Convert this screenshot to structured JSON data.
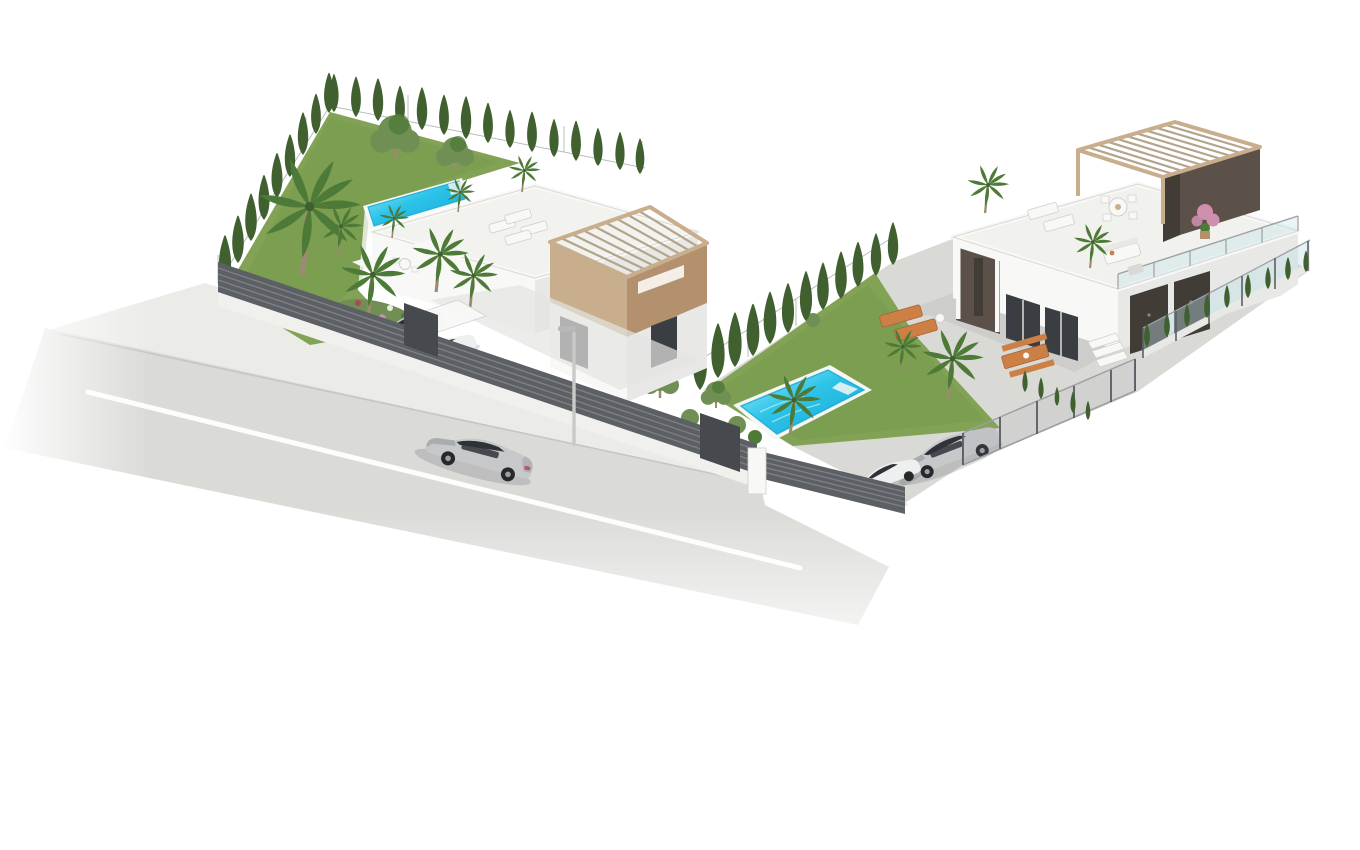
{
  "meta": {
    "type": "architectural-3d-render",
    "description": "Isometric 3D architectural rendering of two modern white villas on an L-shaped plot with gardens, swimming pools, cypress hedges, palm trees, parked cars, dark slatted street fences and a grey asphalt road with a silver sedan, on a plain white background"
  },
  "colors": {
    "bg": "#ffffff",
    "road": "#dadad7",
    "roadEdge": "#c6c6c3",
    "lane": "#fdfdfc",
    "sidewalk": "#ebebe8",
    "grass": "#82a355",
    "grassShade": "#6a8f46",
    "cypress": "#41602f",
    "olive": "#6f8f55",
    "palm": "#4e7a38",
    "trunk": "#9b8b70",
    "water": "#2ec4e9",
    "waterDeep": "#12a7d4",
    "waterLight": "#9ff0fb",
    "coping": "#f6f6f4",
    "white1": "#f8f8f6",
    "white2": "#e8e9e6",
    "white3": "#d8d9d6",
    "edge": "#cfd0cd",
    "tan": "#c9ae8d",
    "tanShade": "#b3916e",
    "beam": "#b3a48c",
    "brown": "#5c5149",
    "brownDark": "#423c36",
    "window": "#3a3e42",
    "fence": "#5c5f63",
    "fenceLine": "#83868a",
    "fenceDark": "#46494d",
    "wallBase": "#f0f0ed",
    "concrete": "#d9d9d6",
    "concreteLight": "#e4e4e1",
    "silver": "#c6c8ca",
    "silverShade": "#93979a",
    "carWhite": "#eef0f0",
    "carGlass": "#2f3338",
    "orange": "#cd8045",
    "orangeDark": "#a9632f",
    "glass": "#bfdfe9",
    "wire": "#9aa0a3",
    "pink": "#cf8fae",
    "flowerRed": "#b3455a",
    "shadow": "rgba(60,65,70,0.18)"
  },
  "scene": {
    "background": "plain white, no horizon",
    "road": {
      "label": "asphalt road running diagonally lower-left, white edge line, fading to white at borders"
    },
    "street_lamp": {
      "label": "slim grey street lamp on sidewalk"
    },
    "vehicles": {
      "driving_car": "silver sedan driving on the road",
      "left_plot_cars": [
        "silver car parked behind street fence",
        "white car under white carport canopy"
      ],
      "right_plot_cars": [
        "silver coupe parked in driveway",
        "white car parked beside it"
      ]
    },
    "left_villa": {
      "label": "two-storey modern white villa",
      "features": [
        "white roof terrace with sun loungers and potted plants",
        "beige upper tower with slatted pergola roof and slot window",
        "dark glazed windows",
        "lap pool along terrace edge",
        "lawn with tall palm, olive trees and cypress hedges on two sides",
        "flower bed with pink and red blooms",
        "lower patio with white dining set",
        "dark horizontal-slat street fence with gates and white pillar"
      ]
    },
    "right_villa": {
      "label": "single-storey modern white villa with roof terrace",
      "features": [
        "roof terrace with wooden pergola and dark brown wall",
        "round dining table with chairs, two loungers, white sofa set, potted plants, pink shrub",
        "glass railing on terrace edge",
        "covered porch with columns",
        "dark sliding glass doors and garage panels",
        "entrance steps",
        "front patio with two orange loungers and orange picnic table",
        "palm trees",
        "lawn with rectangular pool",
        "cypress hedge dividing the plots",
        "driveway parking behind mesh fence",
        "low concrete boundary wall with glass panels and small cypresses"
      ]
    }
  }
}
